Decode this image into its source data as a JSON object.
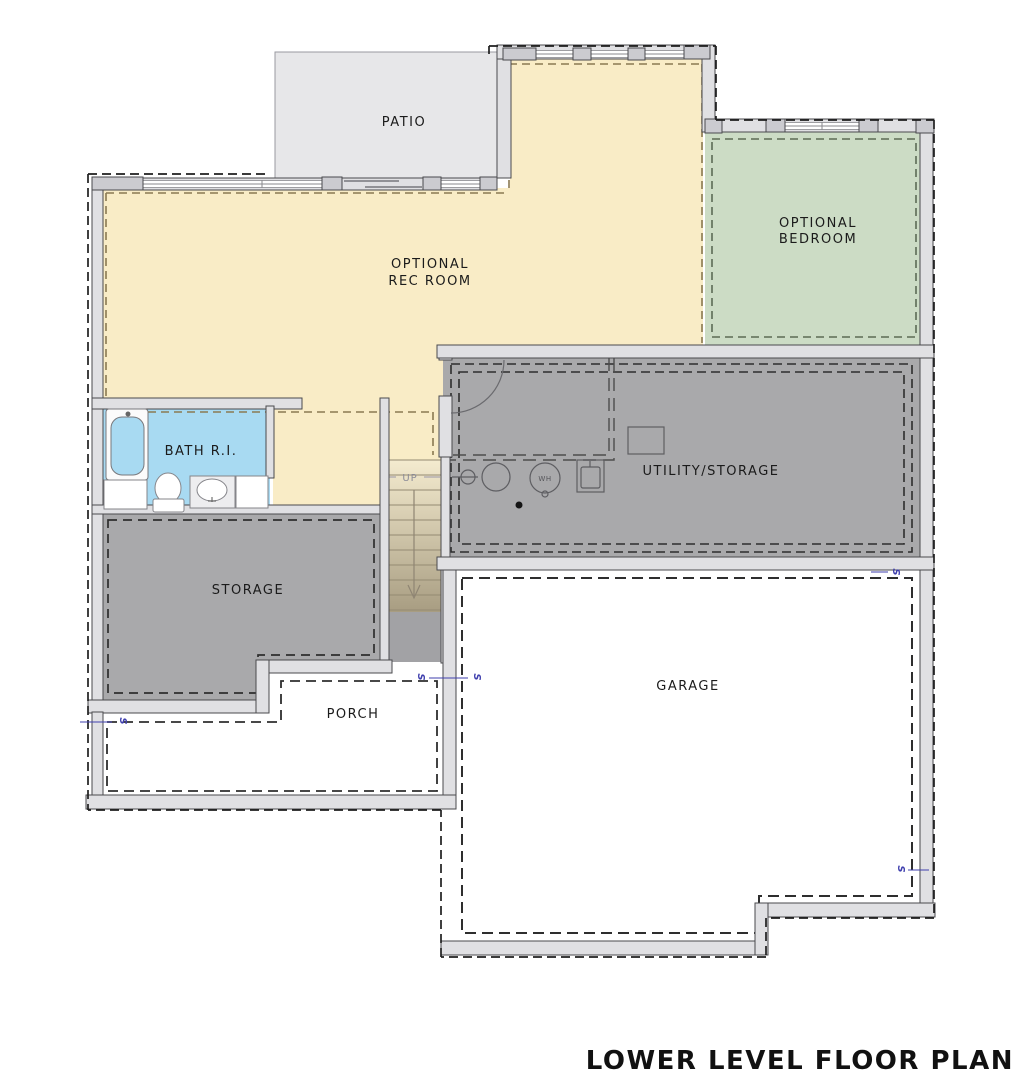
{
  "title": {
    "text": "LOWER LEVEL FLOOR PLAN"
  },
  "rooms": {
    "patio": {
      "label": "PATIO",
      "color": "#e7e7e9"
    },
    "rec_room": {
      "label1": "OPTIONAL",
      "label2": "REC ROOM",
      "color": "#f9ecc6"
    },
    "bedroom": {
      "label1": "OPTIONAL",
      "label2": "BEDROOM",
      "color": "#ccdcc5"
    },
    "utility": {
      "label": "UTILITY/STORAGE",
      "color": "#a9a9ab"
    },
    "bath": {
      "label": "BATH R.I.",
      "color": "#a8daf2"
    },
    "storage": {
      "label": "STORAGE",
      "color": "#a9a9ab"
    },
    "garage": {
      "label": "GARAGE",
      "color": "#ffffff"
    },
    "porch": {
      "label": "PORCH",
      "color": "#ffffff"
    }
  },
  "stairs": {
    "up_label": "UP"
  },
  "fixtures": {
    "water_heater_label": "WH"
  },
  "markers": {
    "symbol": "S"
  },
  "colors": {
    "wall_fill": "#e0e0e3",
    "wall_cap": "#cbcbd0",
    "wall_stroke": "#4a4a4e",
    "boundary_dash": "#1f1f1f",
    "rec_dash": "#8a7a52",
    "bedroom_dash": "#5c6b55",
    "room_dash": "#2e2e2e",
    "marker_blue": "#3f3fae",
    "label_ink": "#1b1b1b",
    "up_ink": "#8b8b97",
    "stair_top": "#f4ebcf",
    "stair_bottom": "#a89d82",
    "landing_gray": "#a2a2a5"
  }
}
